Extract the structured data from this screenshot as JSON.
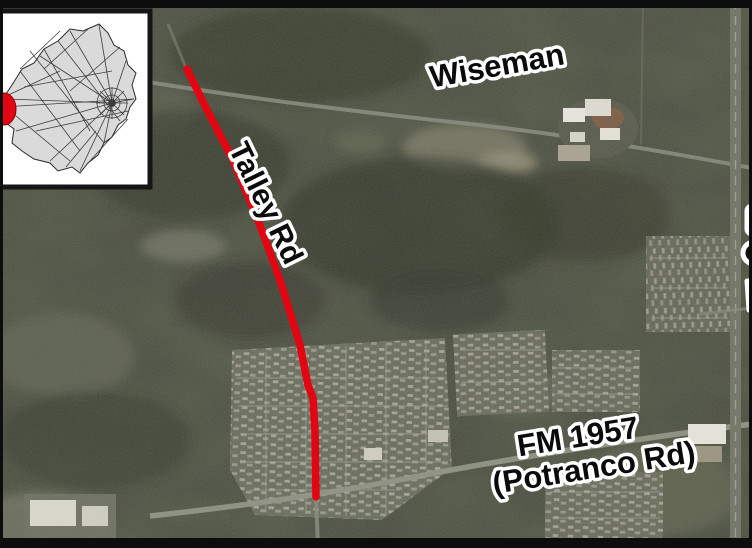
{
  "map": {
    "labels": {
      "top_road": "Wiseman",
      "route_road": "Talley Rd",
      "bottom_road_line1": "FM 1957",
      "bottom_road_line2": "(Potranco Rd)"
    },
    "route": {
      "name": "Talley Rd project corridor highlight",
      "color": "#e20613",
      "points": "187,69 206,108 232,158 258,220 280,280 300,345 308,385 313,398 315,430 316,497"
    },
    "inset": {
      "name": "county roadway network locator",
      "marker_color": "#e20613",
      "background": "#ffffff",
      "county_fill": "#dadada"
    },
    "colors": {
      "aerial_base": "#474a3d",
      "frame": "#0d0d0d",
      "label_fill": "#0b0b0b",
      "label_outline": "#ffffff"
    }
  }
}
